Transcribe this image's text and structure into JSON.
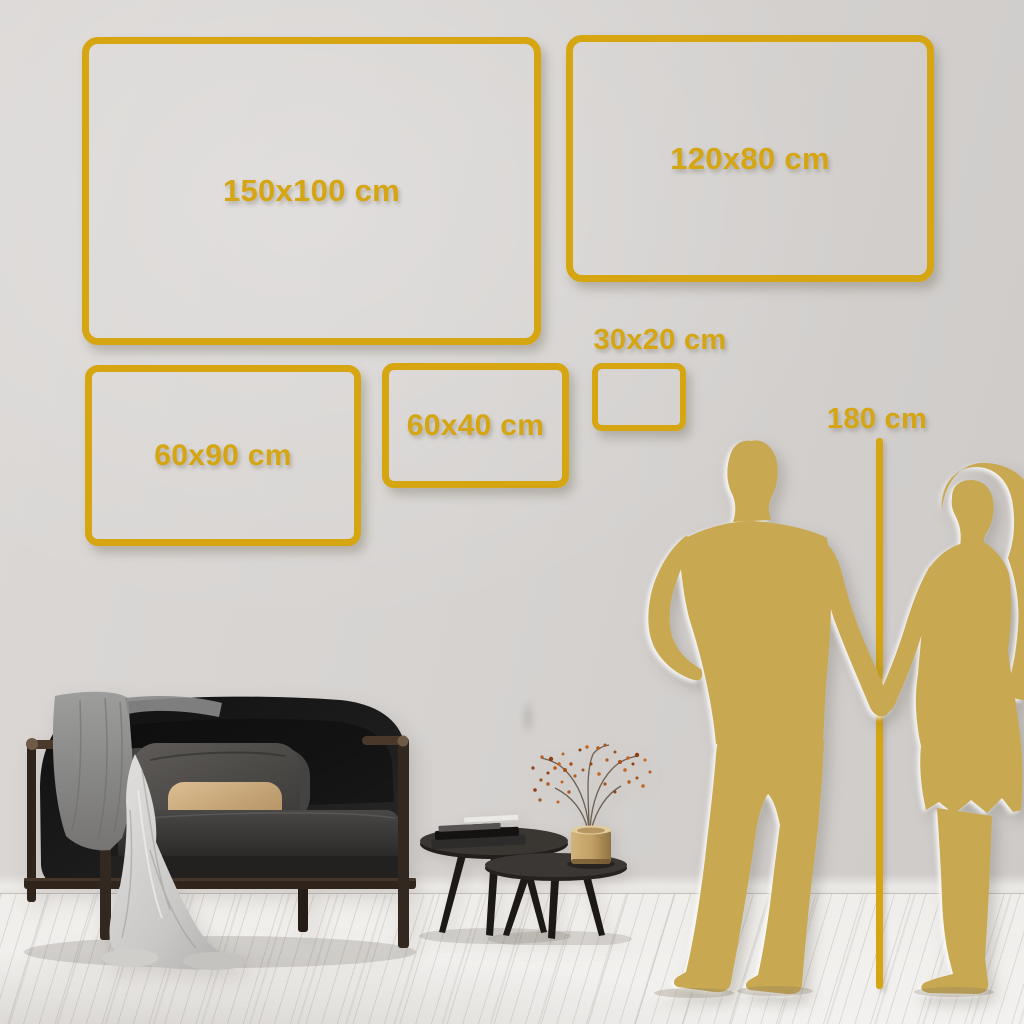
{
  "colors": {
    "frame_gold": "#D5A512",
    "silhouette_gold": "#C8A851",
    "wall": "#D6D3D1",
    "floor": "#F3F1EF"
  },
  "size_frames": [
    {
      "name": "150x100",
      "label": "150x100 cm"
    },
    {
      "name": "120x80",
      "label": "120x80 cm"
    },
    {
      "name": "60x90",
      "label": "60x90 cm"
    },
    {
      "name": "60x40",
      "label": "60x40 cm"
    },
    {
      "name": "30x20",
      "label": "30x20 cm"
    }
  ],
  "height_marker": {
    "label": "180 cm"
  },
  "illustrations": {
    "sofa": "dark velvet loveseat with wood frame, gray throw and beige pillow",
    "coffee_tables": "round nesting tables with books and brass vase with dried branch",
    "couple": "gold silhouette of man and woman holding hands"
  }
}
